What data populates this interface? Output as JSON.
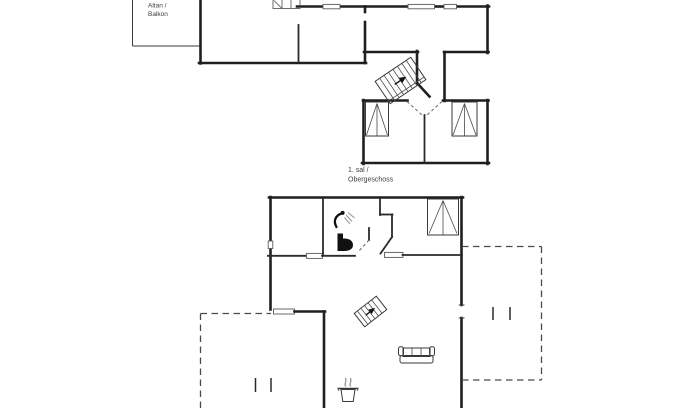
{
  "document": {
    "type": "floor-plan-drawing",
    "background": "#ffffff",
    "wall_color": "#1f1f1f",
    "thin_line_color": "#3a3a3a",
    "dashed_line_color": "#4a4a4a",
    "text_color": "#3c3c3c"
  },
  "upper_floor": {
    "balcony_label": {
      "line1": "Altan /",
      "line2": "Balkon"
    },
    "caption": {
      "line1": "1. sal /",
      "line2": "Obergeschoss"
    },
    "icons": [
      "staircase-icon",
      "wardrobe-icon",
      "wardrobe-icon",
      "washbasin-icon"
    ],
    "features": [
      "balcony-outline",
      "window-openings",
      "door-swing-dashes",
      "room-divider"
    ]
  },
  "ground_floor": {
    "icons": [
      "staircase-icon",
      "wardrobe-icon",
      "toilet-icon",
      "shower-icon",
      "sofa-icon",
      "cooking-pot-icon"
    ],
    "features": [
      "terrace-left-dashed-outline",
      "terrace-right-dashed-outline",
      "terrace-door-bars",
      "door-thresholds"
    ]
  }
}
